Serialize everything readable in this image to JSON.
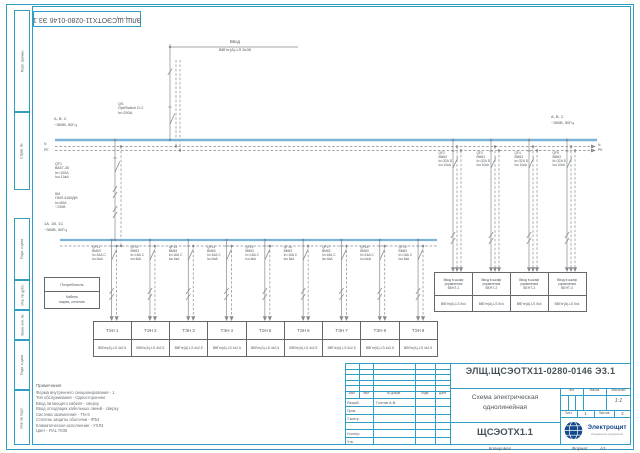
{
  "sheet": {
    "side_labels": [
      "Перв. примен.",
      "Справ. №",
      "Подп. и дата",
      "Инв. № дубл.",
      "Взам. инв. №",
      "Подп. и дата",
      "Инв. № подл."
    ],
    "top_stamp": "ЭЛЩ.ЩСЭОТХ11-0280-0146 Э3.1",
    "copy_label": "Копировал",
    "format_label": "Формат",
    "format_value": "А3"
  },
  "schematic": {
    "input": {
      "name": "Ввод",
      "cable": "ВВГнг(А)-LS 5х35"
    },
    "qs": {
      "lines": [
        "QS",
        "OptiSwitch D-2",
        "In=250А"
      ]
    },
    "main_bus": {
      "phases": "А, В, С",
      "voltage": "~380В, 50Гц",
      "n": "N",
      "pe": "PE"
    },
    "sub_bus": {
      "phases": "1А, 1В, 1С",
      "voltage": "~380В, 50Гц"
    },
    "main_feeder": {
      "qf_lines": [
        "QF1",
        "ВА57-35",
        "In=100А",
        "Icu 10кА"
      ],
      "km_lines": [
        "КМ",
        "ПМЛ-4160ДМ",
        "In=80А",
        "~230В"
      ]
    },
    "legend": {
      "row1": "Потребитель",
      "row2_lines": [
        "Кабель",
        "марка, сечение"
      ]
    },
    "heater_feeders": [
      {
        "qf": "QF11",
        "device": "ВМ63",
        "rating": "In=16А C",
        "icu": "Icu 6кА",
        "consumer": "ТЭН 1",
        "cable": "ВВГнг(А)-LS 4х2,5"
      },
      {
        "qf": "QF12",
        "device": "ВМ63",
        "rating": "In=16А C",
        "icu": "Icu 6кА",
        "consumer": "ТЭН 2",
        "cable": "ВВГнг(А)-LS 4х2,5"
      },
      {
        "qf": "QF13",
        "device": "ВМ63",
        "rating": "In=16А C",
        "icu": "Icu 6кА",
        "consumer": "ТЭН 3",
        "cable": "ВВГнг(А)-LS 4х2,5"
      },
      {
        "qf": "QF14",
        "device": "ВМ63",
        "rating": "In=16А C",
        "icu": "Icu 6кА",
        "consumer": "ТЭН 4",
        "cable": "ВВГнг(А)-LS 4х2,5"
      },
      {
        "qf": "QF15",
        "device": "ВМ63",
        "rating": "In=16А C",
        "icu": "Icu 6кА",
        "consumer": "ТЭН 5",
        "cable": "ВВГнг(А)-LS 4х2,5"
      },
      {
        "qf": "QF16",
        "device": "ВМ63",
        "rating": "In=16А C",
        "icu": "Icu 6кА",
        "consumer": "ТЭН 6",
        "cable": "ВВГнг(А)-LS 4х2,5"
      },
      {
        "qf": "QF17",
        "device": "ВМ63",
        "rating": "In=16А C",
        "icu": "Icu 6кА",
        "consumer": "ТЭН 7",
        "cable": "ВВГнг(А)-LS 4х2,5"
      },
      {
        "qf": "QF18",
        "device": "ВМ63",
        "rating": "In=16А C",
        "icu": "Icu 6кА",
        "consumer": "ТЭН 8",
        "cable": "ВВГнг(А)-LS 4х2,5"
      },
      {
        "qf": "QF19",
        "device": "ВМ63",
        "rating": "In=16А C",
        "icu": "Icu 6кА",
        "consumer": "ТЭН 9",
        "cable": "ВВГнг(А)-LS 4х2,5"
      }
    ],
    "vent_feeders": [
      {
        "qf": "QF2",
        "device": "ВМ63",
        "rating": "In=32А D",
        "icu": "Icu 10кА",
        "consumer_lines": [
          "Ввод в шкаф",
          "управления",
          "ВЕНТ-1"
        ],
        "cable": "ВВГнг(А)-LS 5х4"
      },
      {
        "qf": "QF3",
        "device": "ВМ63",
        "rating": "In=32А D",
        "icu": "Icu 10кА",
        "consumer_lines": [
          "Ввод в шкаф",
          "управления",
          "ВЕНТ-2"
        ],
        "cable": "ВВГнг(А)-LS 5х4"
      },
      {
        "qf": "QF4",
        "device": "ВМ63",
        "rating": "In=32А D",
        "icu": "Icu 10кА",
        "consumer_lines": [
          "Ввод в шкаф",
          "управления",
          "ВЕНТ-3"
        ],
        "cable": "ВВГнг(А)-LS 5х4"
      },
      {
        "qf": "QF5",
        "device": "ВМ63",
        "rating": "In=32А D",
        "icu": "Icu 10кА",
        "consumer_lines": [
          "Ввод в шкаф",
          "управления",
          "ВЕНТ-4"
        ],
        "cable": "ВВГнг(А)-LS 5х4"
      }
    ]
  },
  "notes": {
    "title": "Примечания",
    "lines": [
      "Форма внутреннего секционирования - 1",
      "Тип обслуживания - Одностороннее",
      "Ввод питающего кабеля - сверху",
      "Ввод отходящих кабельных линий - сверху",
      "Система заземления - TN-S",
      "Степень защиты оболочки - IP54",
      "Климатическое исполнение - УХЛ4",
      "Цвет - RAL 7035"
    ]
  },
  "title_block": {
    "designation": "ЭЛЩ.ЩСЭОТХ11-0280-0146 Э3.1",
    "doc_name_lines": [
      "Схема электрическая",
      "однолинейная"
    ],
    "object_name": "ЩСЭОТХ1.1",
    "header_cols": [
      "Изм.",
      "Лист",
      "№ докум.",
      "Подп.",
      "Дата"
    ],
    "roles": [
      {
        "role": "Разраб.",
        "name": "Глотов А.В."
      },
      {
        "role": "Пров.",
        "name": ""
      },
      {
        "role": "Т.контр.",
        "name": ""
      },
      {
        "role": "",
        "name": ""
      },
      {
        "role": "Н.контр.",
        "name": ""
      },
      {
        "role": "Утв.",
        "name": ""
      }
    ],
    "lit_label": "Лит.",
    "mass_label": "Масса",
    "scale_label": "Масштаб",
    "scale_value": "1:1",
    "sheet_label": "Лист",
    "sheet_value": "1",
    "sheets_label": "Листов",
    "sheets_value": "2",
    "logo": {
      "brand": "Электрощит",
      "tagline": "объединение предприятий"
    }
  },
  "colors": {
    "frame": "#2f9ec2",
    "bus": "#7ab4d8",
    "line": "#85898d",
    "text": "#50585e",
    "logo_blue": "#14498c"
  }
}
